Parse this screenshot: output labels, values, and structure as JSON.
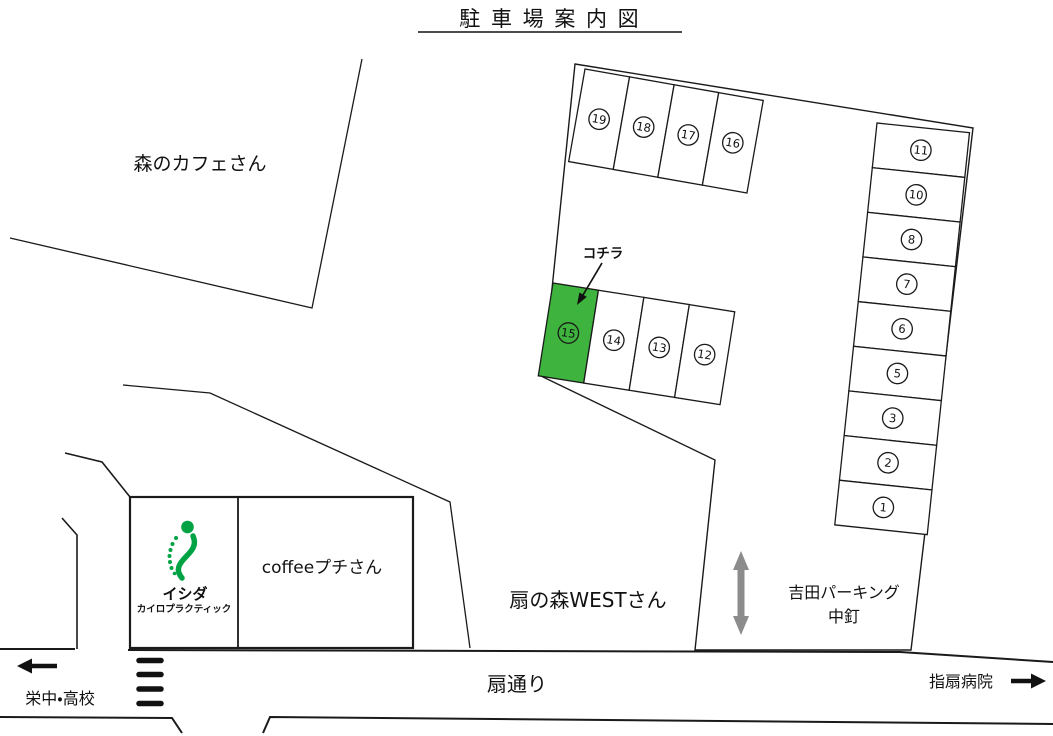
{
  "title": "駐 車 場 案 内 図",
  "colors": {
    "line": "#1a1a1a",
    "highlight_green": "#3eb43e",
    "text_green": "#2fa42f",
    "logo_green": "#00a344",
    "gray_arrow": "#8c8c8c",
    "slot_fill": "#ffffff"
  },
  "labels": {
    "mori_cafe": "森のカフェさん",
    "kochira": "コチラ",
    "ishida_name": "イシダ",
    "ishida_sub": "カイロプラクティック",
    "coffee_petit": "coffeeプチさん",
    "ougi_west": "扇の森WESTさん",
    "yoshida_parking": "吉田パーキング",
    "yoshida_parking_sub": "中釘",
    "ougi_street": "扇通り",
    "sakae_school": "栄中・高校",
    "sashiougi_hospital": "指扇病院"
  },
  "parking": {
    "top_row": [
      19,
      18,
      17,
      16
    ],
    "middle_row": [
      15,
      14,
      13,
      12
    ],
    "right_column": [
      11,
      10,
      8,
      7,
      6,
      5,
      3,
      2,
      1
    ],
    "highlighted_slot": 15
  }
}
